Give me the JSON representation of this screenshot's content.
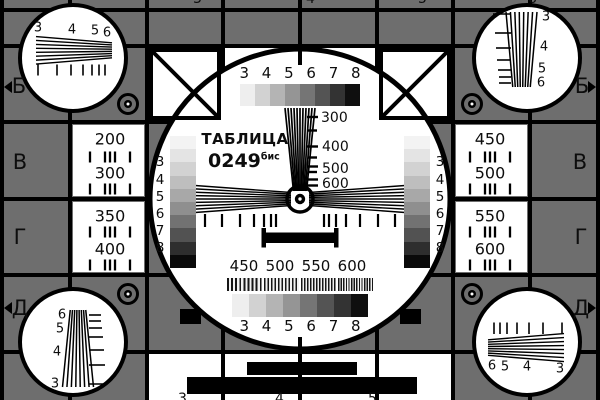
{
  "card": {
    "title_line1": "ТАБЛИЦА",
    "title_number": "0249",
    "title_superscript": "бис"
  },
  "row_labels": {
    "left": {
      "b": "Б",
      "v": "В",
      "g": "Г",
      "d": "Д"
    },
    "right": {
      "b": "Б",
      "v": "В",
      "g": "Г",
      "d": "Д"
    }
  },
  "frequency_boxes": {
    "left_top": [
      "200",
      "300"
    ],
    "left_bottom": [
      "350",
      "400"
    ],
    "right_top": [
      "450",
      "500"
    ],
    "right_bottom": [
      "550",
      "600"
    ]
  },
  "center_circle": {
    "top_digit_row": "3 4 5 6 7 8",
    "bottom_digit_row": "3 4 5 6 7 8",
    "vertical_wedge_labels": [
      "300",
      "400",
      "500",
      "600"
    ],
    "burst_labels": [
      "450",
      "500",
      "550",
      "600"
    ],
    "left_strip_digits": [
      "3",
      "4",
      "5",
      "6",
      "7",
      "8"
    ],
    "right_strip_digits": [
      "3",
      "4",
      "5",
      "6",
      "7",
      "8"
    ]
  },
  "corner_circles": {
    "top_left_digits": [
      "3",
      "4",
      "5",
      "6"
    ],
    "top_right_digits": [
      "3",
      "4",
      "5",
      "6"
    ],
    "bottom_left_digits": [
      "6",
      "5",
      "4",
      "3"
    ],
    "bottom_right_digits": [
      "6",
      "5",
      "4",
      "3"
    ]
  },
  "edge_partial_digits": {
    "top": [
      "3",
      "4",
      "5",
      "6"
    ],
    "bottom": [
      "3",
      "4",
      "5"
    ]
  },
  "colors": {
    "background_gray": "#6e6e6e",
    "line_black": "#000000",
    "white": "#ffffff",
    "text_dark": "#0d0d0d"
  },
  "grayscale_horizontal_steps": [
    "#eeeeee",
    "#d2d2d2",
    "#b4b4b4",
    "#959595",
    "#757575",
    "#545454",
    "#333333",
    "#0f0f0f"
  ],
  "grayscale_vertical_steps": [
    "#f3f3f3",
    "#e4e4e4",
    "#d2d2d2",
    "#bebebe",
    "#a8a8a8",
    "#8f8f8f",
    "#727272",
    "#525252",
    "#2e2e2e",
    "#0a0a0a"
  ]
}
